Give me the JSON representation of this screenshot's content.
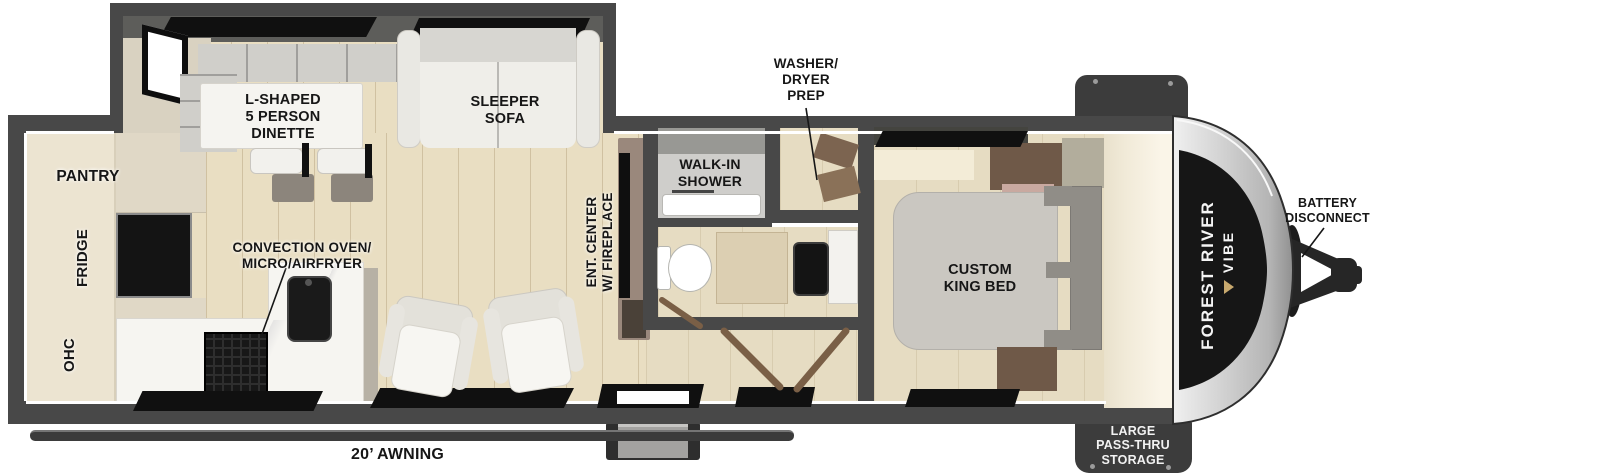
{
  "floorplan": {
    "brand": {
      "manufacturer": "FOREST RIVER",
      "model": "VIBE"
    },
    "labels": {
      "dinette": "L-SHAPED\n5 PERSON\nDINETTE",
      "sleeper_sofa": "SLEEPER\nSOFA",
      "pantry": "PANTRY",
      "fridge": "FRIDGE",
      "ohc": "OHC",
      "convection": "CONVECTION OVEN/\nMICRO/AIRFRYER",
      "ent_center": "ENT. CENTER\nW/ FIREPLACE",
      "walk_in_shower": "WALK-IN\nSHOWER",
      "washer_dryer_prep": "WASHER/\nDRYER\nPREP",
      "custom_king_bed": "CUSTOM\nKING BED",
      "battery_disconnect": "BATTERY\nDISCONNECT",
      "awning": "20’ AWNING",
      "pass_thru_storage": "LARGE\nPASS-THRU\nSTORAGE"
    },
    "colors": {
      "wall": "#484848",
      "floor_wood": "#e9dec2",
      "floor_tan": "#e6dcc2",
      "cabinet_cream": "#ece4d1",
      "appliance_black": "#141414",
      "cap_silver": "#d9d9d9",
      "windshield_black": "#161616",
      "label_text": "#161616",
      "storage_tab": "#3c3c3c",
      "door_wood": "#7a5f46"
    }
  }
}
